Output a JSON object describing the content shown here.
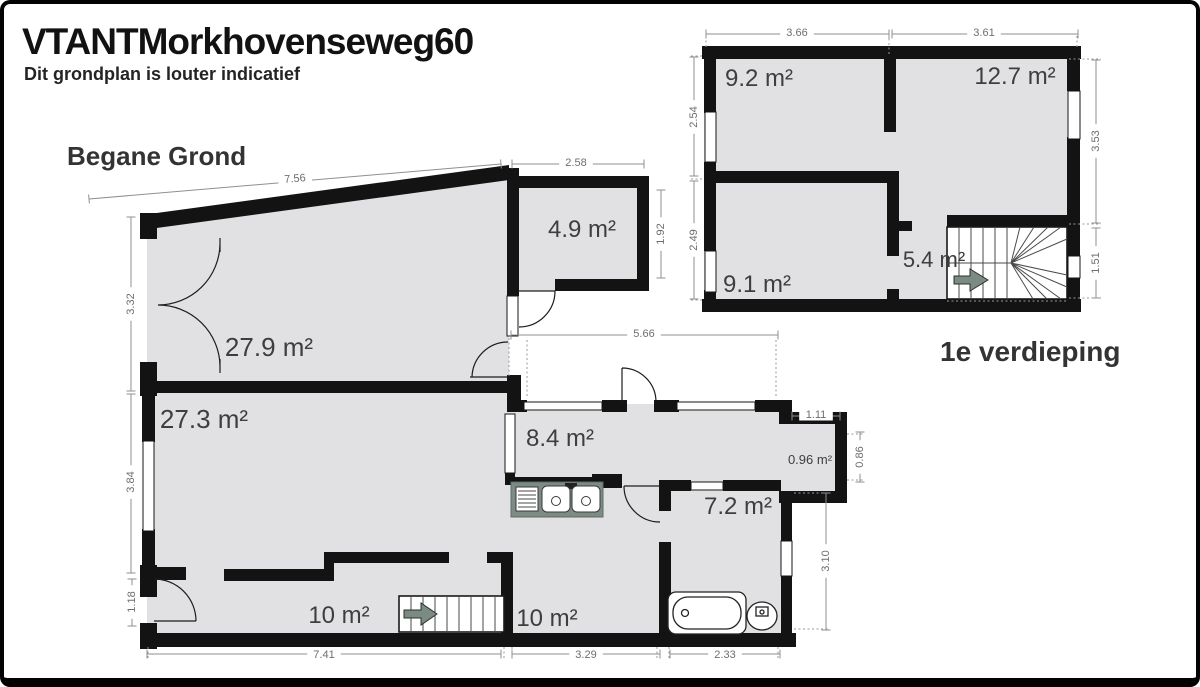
{
  "header": {
    "title": "VTANTMorkhovenseweg60",
    "subtitle": "Dit grondplan is louter indicatief"
  },
  "ground_floor": {
    "label": "Begane Grond",
    "rooms": {
      "living_front": "27.9 m²",
      "living_back": "27.3 m²",
      "storage": "4.9 m²",
      "hall": "8.4 m²",
      "porch": "0.96 m²",
      "bathroom": "7.2 m²",
      "hallway": "10 m²",
      "back_room": "10 m²"
    },
    "dims": {
      "top_width": "7.56",
      "storage_width": "2.58",
      "storage_depth": "1.92",
      "left_front": "3.32",
      "left_back": "3.84",
      "entrance": "1.18",
      "bottom_left": "7.41",
      "bottom_middle": "3.29",
      "bottom_right": "2.33",
      "hall_width": "5.66",
      "porch_width": "1.11",
      "porch_depth": "0.86",
      "right_side": "3.10"
    }
  },
  "first_floor": {
    "label": "1e verdieping",
    "rooms": {
      "bedroom_left": "9.2 m²",
      "bedroom_right": "12.7 m²",
      "bedroom_back": "9.1 m²",
      "landing": "5.4 m²"
    },
    "dims": {
      "top_left": "3.66",
      "top_right": "3.61",
      "left_upper": "2.54",
      "left_lower": "2.49",
      "right_upper": "3.53",
      "right_lower": "1.51"
    }
  },
  "colors": {
    "wall": "#131313",
    "room_fill": "#e1e1e3",
    "dim_line": "#8f8f8f",
    "dim_text": "#6e6e6e",
    "room_label": "#3e3e3e",
    "kitchen_counter": "#7c8b84",
    "stair_arrow": "#7b8a82"
  }
}
